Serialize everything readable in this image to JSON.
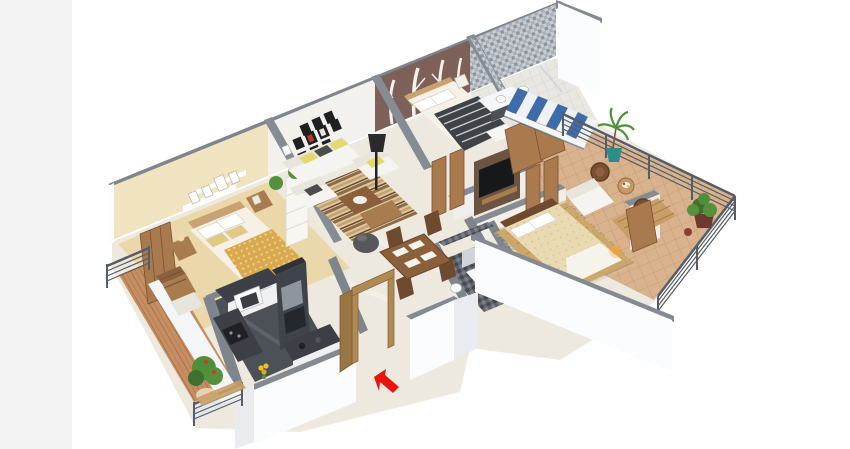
{
  "scene": {
    "description": "3D isometric floor plan render of a multi-room apartment viewed from the front-left, on a white background",
    "projection": "dimetric",
    "background": "#ffffff",
    "left_margin_band": "#f3f3f4"
  },
  "colors": {
    "arrow_red": "#e8150d",
    "awning_blue": "#3e6cab",
    "awning_white": "#eef2f7",
    "accent_wall_brown": "#7d6158",
    "bedroom1_wall_cream": "#f0e3c0",
    "gallery_wall_white": "#f2f1ed",
    "wall_top_gray": "#7e858d",
    "exterior_wall_white": "#fbfcfd",
    "marble_floor": "#eee9df",
    "terrace_floor_tan": "#d9b28e",
    "balcony_floor_terracotta": "#c58e63",
    "kitchen_counter_dark": "#3c4046",
    "rail_dark": "#565d66",
    "wood_medium": "#a97c4f",
    "sofa_white": "#f5f4f0",
    "quilt_gold": "#d9a94e",
    "rug_gold": "#c9a86a",
    "plant_green": "#55903c",
    "tv_black": "#17181a",
    "sconce_amber": "#f0a23c"
  },
  "rooms": [
    {
      "id": "bedroom-1",
      "furniture": [
        "double bed with gold patterned quilt",
        "wall shelves with photo frames",
        "two nightstands with lamps",
        "wooden wardrobe",
        "white shelving unit",
        "small plant"
      ]
    },
    {
      "id": "living-room",
      "furniture": [
        "three-seat white sofa",
        "two white armchairs",
        "striped area rug",
        "wooden coffee table",
        "dark bean bag",
        "black floor lamp",
        "gallery wall of black picture frames",
        "potted plant"
      ]
    },
    {
      "id": "master-bedroom",
      "furniture": [
        "double bed with striped blanket",
        "birch tree mural accent wall",
        "white table lamp",
        "wooden wardrobes"
      ]
    },
    {
      "id": "master-bathroom",
      "furniture": [
        "mosaic tiled walls",
        "washbasin counter",
        "toilet"
      ]
    },
    {
      "id": "terrace",
      "furniture": [
        "blue-white striped awning",
        "metal bar railing",
        "palm plant in teal pot",
        "two wicker chairs",
        "round table",
        "bushy plant in planter",
        "white lounger",
        "wooden deck"
      ]
    },
    {
      "id": "bedroom-2",
      "furniture": [
        "double bed with tufted cream bedspread",
        "gold area rug",
        "dark headboard",
        "wooden wardrobe",
        "two amber wall sconces"
      ]
    },
    {
      "id": "common-bathroom",
      "furniture": [
        "dark mosaic tiles",
        "washbasin with mirror",
        "toilet"
      ]
    },
    {
      "id": "kitchen",
      "furniture": [
        "L-shaped dark granite counter",
        "white base cabinets",
        "microwave",
        "tall refrigerator unit",
        "sink",
        "hob",
        "yellow flowers"
      ]
    },
    {
      "id": "dining-area",
      "furniture": [
        "wooden dining table",
        "four wooden chairs",
        "four white place settings",
        "wooden sideboard"
      ]
    },
    {
      "id": "hallway",
      "furniture": [
        "wall-mounted TV on wood panel",
        "wooden console shelf",
        "wooden door panels"
      ]
    },
    {
      "id": "entrance",
      "furniture": [
        "open wooden door frame",
        "red entrance arrow"
      ]
    },
    {
      "id": "left-balcony",
      "furniture": [
        "metal bar railing",
        "wooden chair",
        "side table",
        "potted plant",
        "wooden slat bench"
      ]
    }
  ],
  "indicators": {
    "entrance_arrow": {
      "shape": "solid arrow",
      "direction": "pointing up-left toward entrance door",
      "color": "#e8150d"
    }
  }
}
